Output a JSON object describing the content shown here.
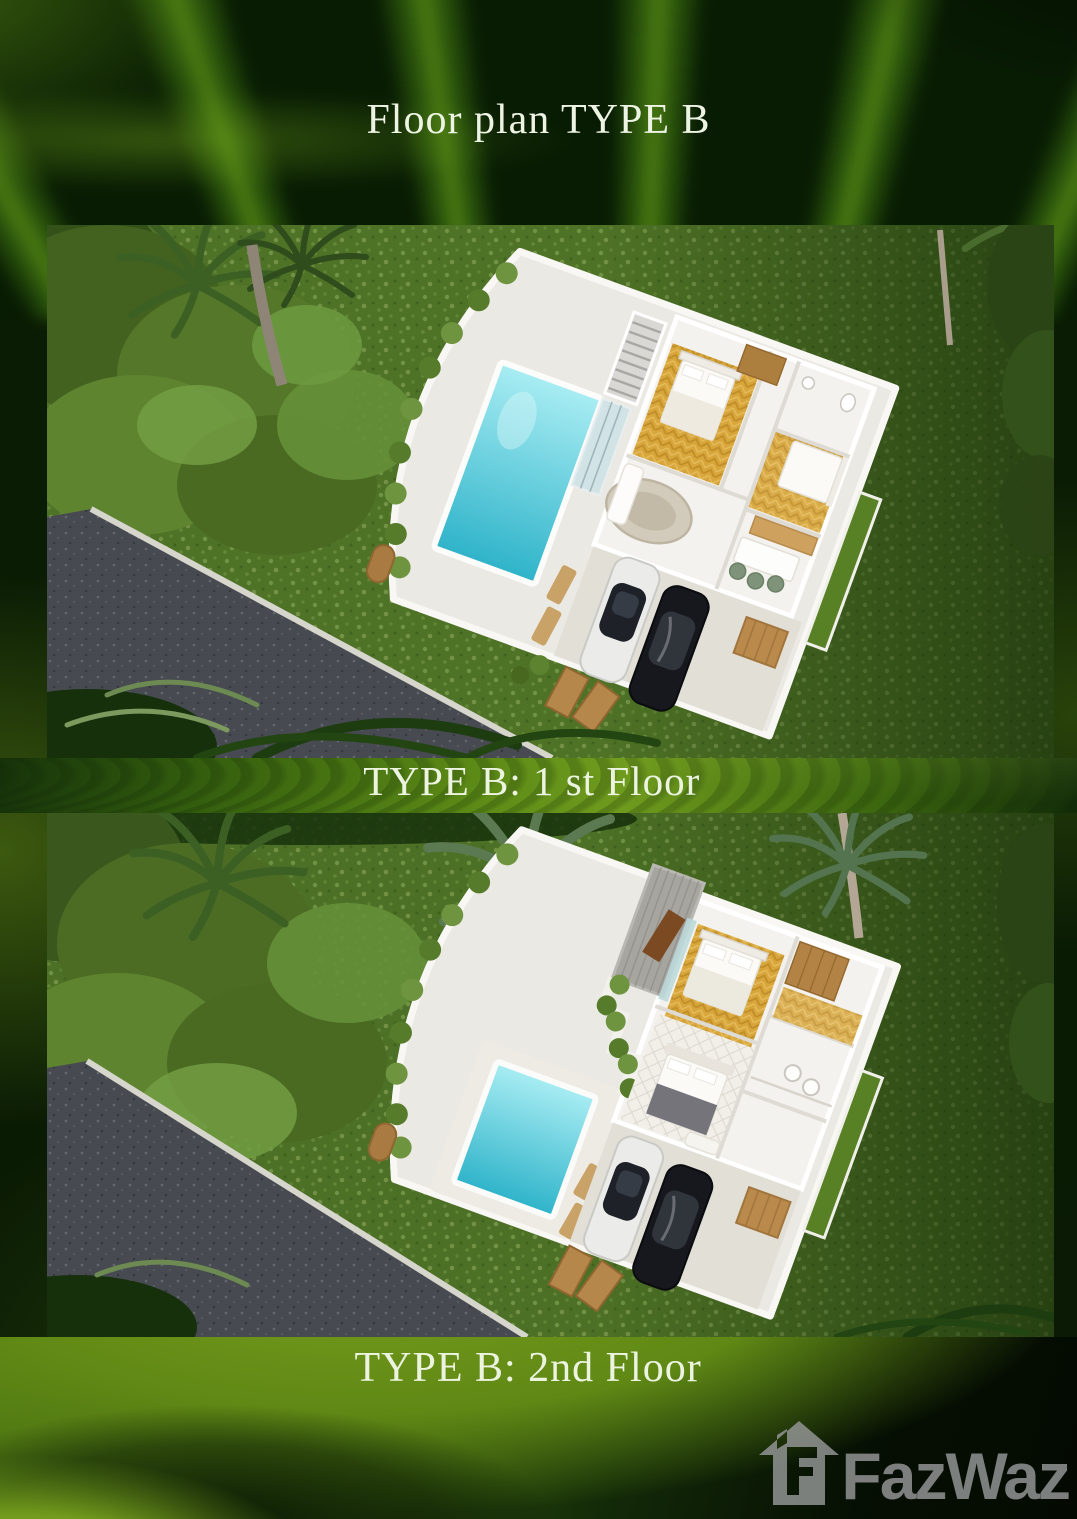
{
  "page": {
    "title": "Floor plan TYPE B",
    "floors": [
      {
        "caption": "TYPE B: 1 st Floor"
      },
      {
        "caption": "TYPE B: 2nd Floor"
      }
    ],
    "watermark": {
      "brand": "FazWaz",
      "icon": "house-icon"
    },
    "colors": {
      "background_dark_green": "#0b1d04",
      "leaf_green": "#5e8a16",
      "leaf_bright": "#8fb324",
      "title_text": "#eef4e4",
      "caption_text": "#ecf3df",
      "grass": "#4e7226",
      "pool_water": "#2eb3c9",
      "villa_white": "#f4f2ee",
      "gold_floor": "#d8a63a",
      "wood": "#b5874b",
      "asphalt": "#474a50",
      "turf_strip": "#588024",
      "watermark_gray": "#969998"
    }
  }
}
